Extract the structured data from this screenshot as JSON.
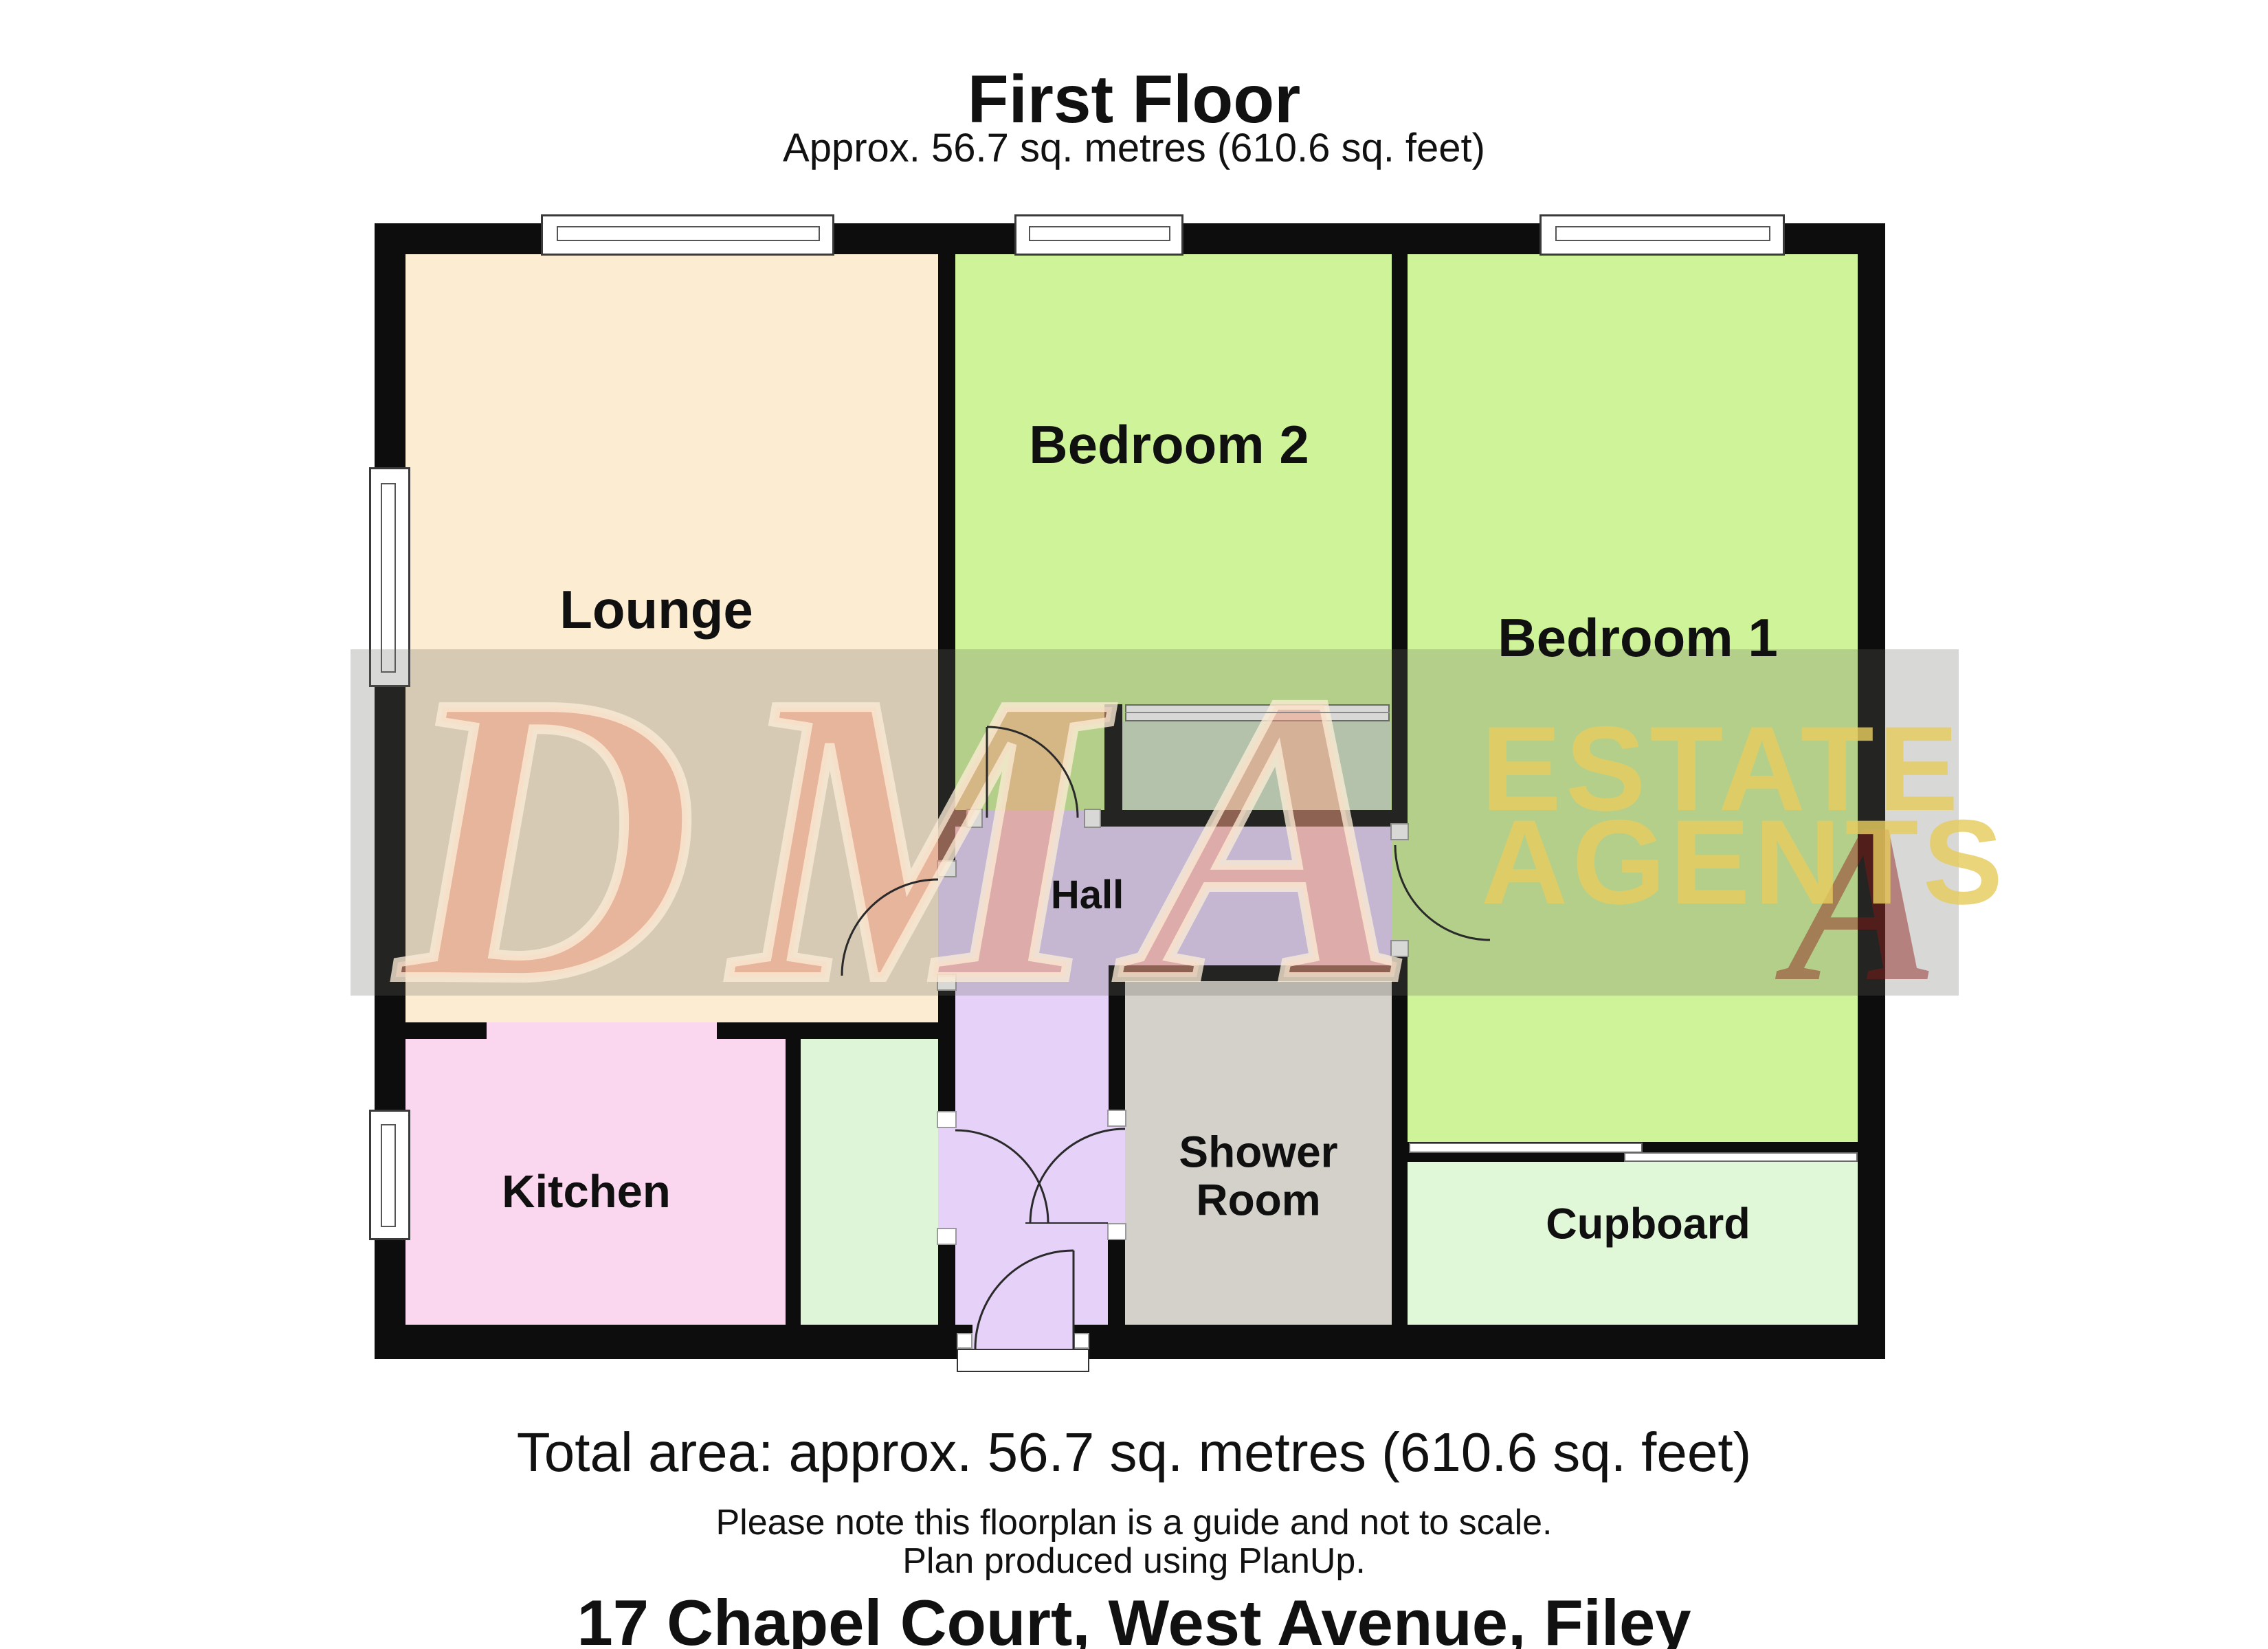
{
  "header": {
    "title": "First Floor",
    "subtitle": "Approx. 56.7 sq. metres (610.6 sq. feet)"
  },
  "rooms": {
    "lounge": "Lounge",
    "bedroom2": "Bedroom 2",
    "bedroom1": "Bedroom 1",
    "hall": "Hall",
    "kitchen": "Kitchen",
    "shower_room": "Shower Room",
    "cupboard": "Cupboard"
  },
  "watermark": {
    "logo": "DMA",
    "line1": "ESTATE",
    "line2": "AGENTS",
    "shadow_letter": "A"
  },
  "footer": {
    "total_area": "Total area: approx. 56.7 sq. metres (610.6 sq. feet)",
    "note1": "Please note this floorplan is a guide and not to scale.",
    "note2": "Plan produced using PlanUp.",
    "address": "17 Chapel Court, West Avenue, Filey"
  },
  "colors": {
    "wall": "#0d0d0d",
    "lounge": "#fcecd2",
    "kitchen": "#fad7ee",
    "bedroom": "#cff398",
    "hall": "#e6d1f9",
    "shower": "#d4d0ca",
    "cupboard": "#e0f7d8",
    "strip": "#def5d8",
    "teal": "#cfe2c6",
    "band": "rgba(105,105,100,0.26)",
    "dma": "rgba(246,160,130,0.50)",
    "dmaOutline": "rgba(251,236,214,0.78)",
    "agents": "rgba(230,204,94,0.82)",
    "redA": "rgba(140,25,20,0.45)"
  }
}
